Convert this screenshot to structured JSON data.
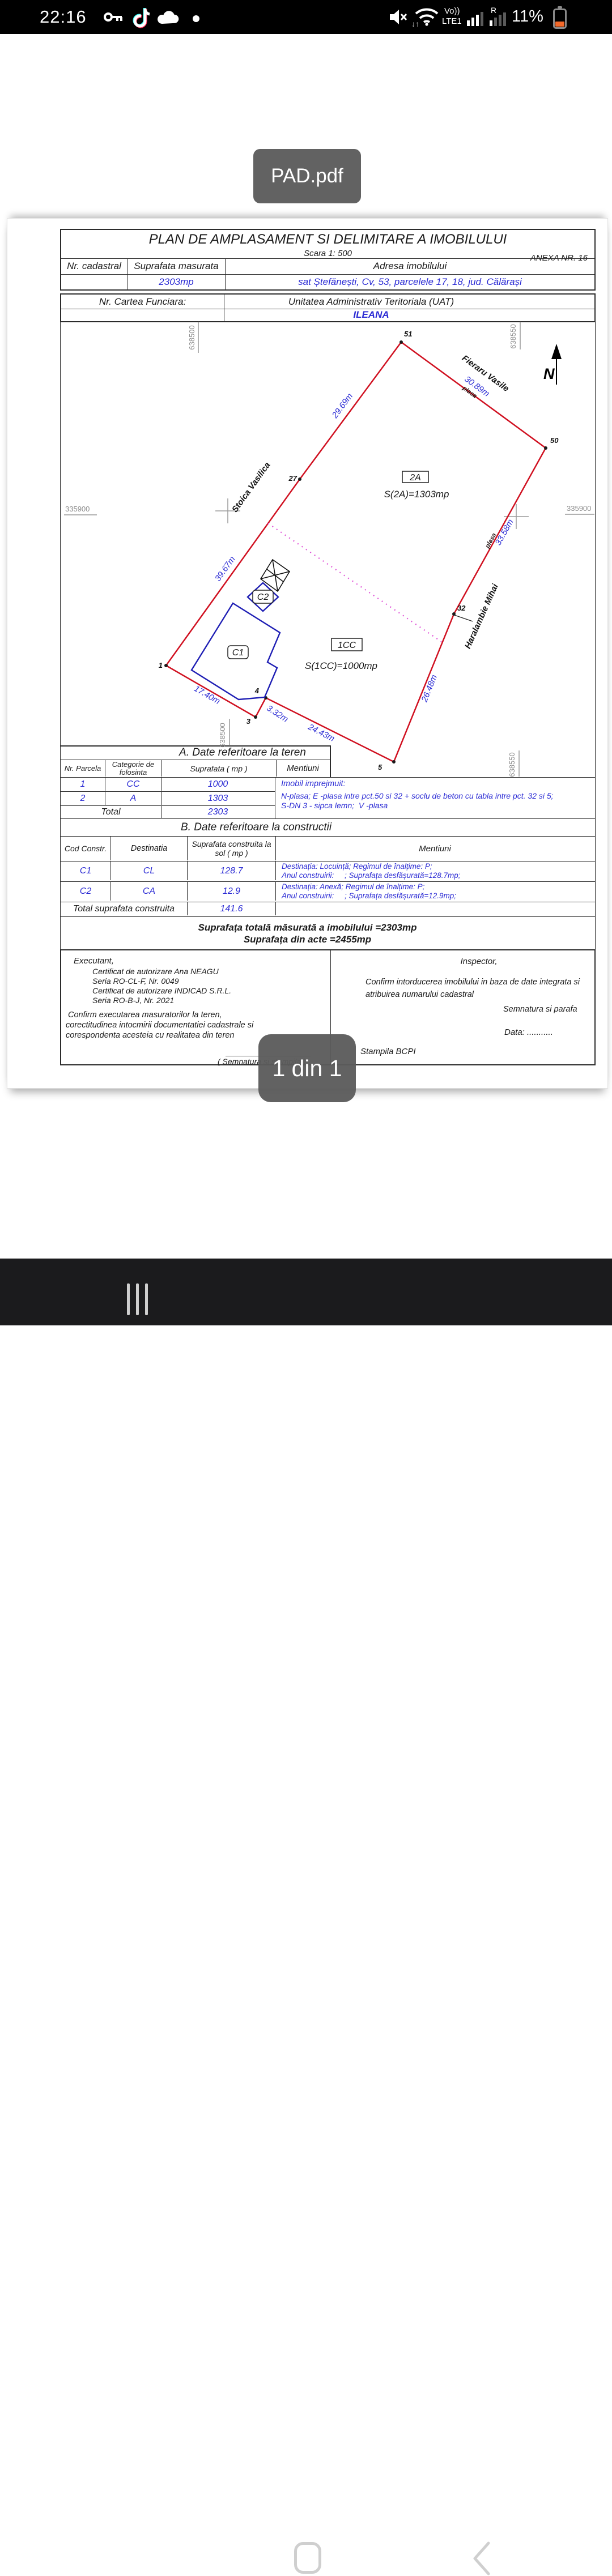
{
  "status_bar": {
    "time": "22:16",
    "network": {
      "volte": "Vo))",
      "lte": "LTE1",
      "roaming": "R"
    },
    "battery_pct": "11%"
  },
  "viewer": {
    "file_toast": "PAD.pdf",
    "page_toast": "1 din 1"
  },
  "doc": {
    "title": "PLAN DE AMPLASAMENT SI DELIMITARE A IMOBILULUI",
    "scale": "Scara 1: 500",
    "anexa": "ANEXA NR. 16",
    "id_table": {
      "h_cadastral": "Nr. cadastral",
      "h_suprafata": "Suprafata masurata",
      "h_adresa": "Adresa imobilului",
      "v_suprafata": "2303mp",
      "v_adresa": "sat Ștefănești, Cv, 53, parcelele 17, 18, jud. Călărași"
    },
    "cf_table": {
      "h_cf": "Nr. Cartea Funciara:",
      "h_uat": "Unitatea Administrativ Teritoriala (UAT)",
      "v_uat": "ILEANA"
    },
    "map": {
      "north": "N",
      "grid": {
        "top_left": "638500",
        "top_right": "638550",
        "bottom_left": "638500",
        "bottom_right": "638550",
        "mid_left": "335900",
        "mid_right": "335900"
      },
      "parcels": [
        {
          "code": "2A",
          "area": "S(2A)=1303mp"
        },
        {
          "code": "1CC",
          "area": "S(1CC)=1000mp"
        }
      ],
      "buildings": [
        "C1",
        "C2"
      ],
      "owners": [
        "Stoica Vasilica",
        "Fieraru Vasile",
        "Haralambie Mihai"
      ],
      "fences": [
        "plasa",
        "plasa"
      ],
      "dims": [
        "29.69m",
        "30.89m",
        "33.58m",
        "39.67m",
        "26.48m",
        "17.40m",
        "3.32m",
        "24.43m"
      ],
      "points": [
        "51",
        "50",
        "27",
        "32",
        "1",
        "3",
        "4",
        "5"
      ]
    },
    "section_a": {
      "title": "A. Date referitoare la teren",
      "h_nr": "Nr. Parcela",
      "h_cat": "Categorie de folosinta",
      "h_sup": "Suprafata ( mp )",
      "h_men": "Mentiuni",
      "rows": [
        {
          "nr": "1",
          "cat": "CC",
          "sup": "1000"
        },
        {
          "nr": "2",
          "cat": "A",
          "sup": "1303"
        }
      ],
      "total_label": "Total",
      "total_value": "2303",
      "mentiuni": [
        "Imobil imprejmuit:",
        "N-plasa; E -plasa intre pct.50 si 32 + soclu de beton cu tabla intre pct. 32 si 5;",
        "S-DN 3 - sipca lemn;  V -plasa"
      ]
    },
    "section_b": {
      "title": "B. Date referitoare la constructii",
      "h_cod": "Cod Constr.",
      "h_dest": "Destinatia",
      "h_sup": "Suprafata construita la sol ( mp )",
      "h_men": "Mentiuni",
      "rows": [
        {
          "cod": "C1",
          "dest": "CL",
          "sup": "128.7",
          "m1": "Destinația: Locuință; Regimul de înalțime: P;",
          "m2": "Anul construirii:     ; Suprafața desfășurată=128.7mp;"
        },
        {
          "cod": "C2",
          "dest": "CA",
          "sup": "12.9",
          "m1": "Destinația: Anexă; Regimul de înalțime: P;",
          "m2": "Anul construirii:     ; Suprafața desfășurată=12.9mp;"
        }
      ],
      "total_label": "Total suprafata construita",
      "total_value": "141.6"
    },
    "totals": {
      "measured": "Suprafața totală măsurată a imobilului =2303mp",
      "acts": "Suprafața din acte =2455mp"
    },
    "executant": {
      "label": "Executant,",
      "lines": [
        "Certificat de autorizare Ana NEAGU",
        "Seria RO-CL-F, Nr. 0049",
        "Certificat de autorizare INDICAD S.R.L.",
        "Seria RO-B-J, Nr. 2021"
      ],
      "confirm": [
        "Confirm executarea masuratorilor la teren,",
        "corectitudinea intocmirii documentatiei cadastrale si",
        "corespondenta acesteia cu realitatea din teren"
      ],
      "signature": "( Semnatura si stampila )"
    },
    "inspector": {
      "label": "Inspector,",
      "confirm": [
        "Confirm intorducerea imobilului in baza de date integrata si",
        "atribuirea numarului cadastral"
      ],
      "signature": "Semnatura si parafa",
      "date": "Data: ...........",
      "stamp": "Stampila BCPI"
    }
  }
}
